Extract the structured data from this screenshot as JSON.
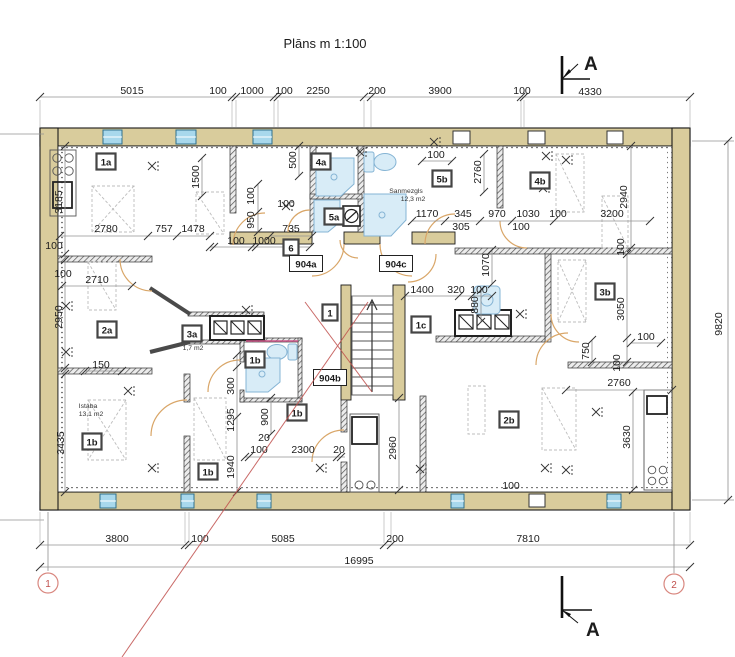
{
  "title": "Plāns  m  1:100",
  "scale_note": "1:100",
  "section_marker": "A",
  "grid_bubbles": [
    "1",
    "2"
  ],
  "colors": {
    "wall_tan": "#d9cc9c",
    "window_blue": "#a8d8ec",
    "markup_red": "#c0504d",
    "fixture_blue": "#d8ecf7",
    "door_arc": "#d9a668"
  },
  "annotations": [
    {
      "t": "Sanmezgls",
      "x": 406,
      "y": 193
    },
    {
      "t": "12,3 m2",
      "x": 413,
      "y": 201
    },
    {
      "t": "1,7 m2",
      "x": 193,
      "y": 350
    },
    {
      "t": "Istaba",
      "x": 88,
      "y": 408
    },
    {
      "t": "13,1 m2",
      "x": 91,
      "y": 416
    }
  ],
  "room_labels": [
    {
      "t": "1a",
      "x": 106,
      "y": 162
    },
    {
      "t": "4a",
      "x": 321,
      "y": 162
    },
    {
      "t": "5a",
      "x": 334,
      "y": 217
    },
    {
      "t": "5b",
      "x": 442,
      "y": 179
    },
    {
      "t": "4b",
      "x": 540,
      "y": 181
    },
    {
      "t": "6",
      "x": 291,
      "y": 248
    },
    {
      "t": "904a",
      "x": 306,
      "y": 264
    },
    {
      "t": "904c",
      "x": 396,
      "y": 264
    },
    {
      "t": "904b",
      "x": 330,
      "y": 378
    },
    {
      "t": "1",
      "x": 330,
      "y": 313
    },
    {
      "t": "1c",
      "x": 421,
      "y": 325
    },
    {
      "t": "3b",
      "x": 605,
      "y": 292
    },
    {
      "t": "2a",
      "x": 107,
      "y": 330
    },
    {
      "t": "3a",
      "x": 192,
      "y": 334
    },
    {
      "t": "1b",
      "x": 255,
      "y": 360
    },
    {
      "t": "1b",
      "x": 297,
      "y": 413
    },
    {
      "t": "1b",
      "x": 92,
      "y": 442
    },
    {
      "t": "1b",
      "x": 208,
      "y": 472
    },
    {
      "t": "2b",
      "x": 509,
      "y": 420
    }
  ],
  "dimension_labels": [
    {
      "t": "5015",
      "x": 132,
      "y": 94
    },
    {
      "t": "100",
      "x": 218,
      "y": 94
    },
    {
      "t": "1000",
      "x": 252,
      "y": 94
    },
    {
      "t": "100",
      "x": 284,
      "y": 94
    },
    {
      "t": "2250",
      "x": 318,
      "y": 94
    },
    {
      "t": "200",
      "x": 377,
      "y": 94
    },
    {
      "t": "3900",
      "x": 440,
      "y": 94
    },
    {
      "t": "100",
      "x": 522,
      "y": 94
    },
    {
      "t": "4330",
      "x": 590,
      "y": 95
    },
    {
      "t": "3800",
      "x": 117,
      "y": 542
    },
    {
      "t": "100",
      "x": 200,
      "y": 542
    },
    {
      "t": "5085",
      "x": 283,
      "y": 542
    },
    {
      "t": "200",
      "x": 395,
      "y": 542
    },
    {
      "t": "7810",
      "x": 528,
      "y": 542
    },
    {
      "t": "16995",
      "x": 359,
      "y": 564
    },
    {
      "t": "9820",
      "x": 722,
      "y": 324,
      "r": 1
    },
    {
      "t": "3185",
      "x": 62,
      "y": 202,
      "r": 1
    },
    {
      "t": "100",
      "x": 54,
      "y": 249
    },
    {
      "t": "100",
      "x": 63,
      "y": 277
    },
    {
      "t": "2950",
      "x": 62,
      "y": 317,
      "r": 1
    },
    {
      "t": "3435",
      "x": 64,
      "y": 443,
      "r": 1
    },
    {
      "t": "2780",
      "x": 106,
      "y": 232
    },
    {
      "t": "757",
      "x": 164,
      "y": 232
    },
    {
      "t": "1478",
      "x": 193,
      "y": 232
    },
    {
      "t": "1500",
      "x": 199,
      "y": 177,
      "r": 1
    },
    {
      "t": "500",
      "x": 296,
      "y": 160,
      "r": 1
    },
    {
      "t": "100",
      "x": 254,
      "y": 196,
      "r": 1
    },
    {
      "t": "950",
      "x": 254,
      "y": 220,
      "r": 1
    },
    {
      "t": "100",
      "x": 236,
      "y": 244
    },
    {
      "t": "1000",
      "x": 264,
      "y": 244
    },
    {
      "t": "735",
      "x": 291,
      "y": 232
    },
    {
      "t": "100",
      "x": 286,
      "y": 207
    },
    {
      "t": "100",
      "x": 436,
      "y": 158
    },
    {
      "t": "2760",
      "x": 481,
      "y": 172,
      "r": 1
    },
    {
      "t": "2940",
      "x": 627,
      "y": 197,
      "r": 1
    },
    {
      "t": "1170",
      "x": 427,
      "y": 217
    },
    {
      "t": "345",
      "x": 463,
      "y": 217
    },
    {
      "t": "970",
      "x": 497,
      "y": 217
    },
    {
      "t": "305",
      "x": 461,
      "y": 230
    },
    {
      "t": "1030",
      "x": 528,
      "y": 217
    },
    {
      "t": "100",
      "x": 558,
      "y": 217
    },
    {
      "t": "100",
      "x": 521,
      "y": 230
    },
    {
      "t": "3200",
      "x": 612,
      "y": 217
    },
    {
      "t": "100",
      "x": 624,
      "y": 247,
      "r": 1
    },
    {
      "t": "1400",
      "x": 422,
      "y": 293
    },
    {
      "t": "320",
      "x": 456,
      "y": 293
    },
    {
      "t": "100",
      "x": 479,
      "y": 293
    },
    {
      "t": "1070",
      "x": 489,
      "y": 265,
      "r": 1
    },
    {
      "t": "880",
      "x": 478,
      "y": 305,
      "r": 1
    },
    {
      "t": "3050",
      "x": 624,
      "y": 309,
      "r": 1
    },
    {
      "t": "100",
      "x": 646,
      "y": 340
    },
    {
      "t": "750",
      "x": 589,
      "y": 351,
      "r": 1
    },
    {
      "t": "100",
      "x": 620,
      "y": 363,
      "r": 1
    },
    {
      "t": "2760",
      "x": 619,
      "y": 386
    },
    {
      "t": "3630",
      "x": 630,
      "y": 437,
      "r": 1
    },
    {
      "t": "100",
      "x": 511,
      "y": 489
    },
    {
      "t": "2710",
      "x": 97,
      "y": 283
    },
    {
      "t": "150",
      "x": 101,
      "y": 368
    },
    {
      "t": "300",
      "x": 234,
      "y": 386,
      "r": 1
    },
    {
      "t": "1295",
      "x": 234,
      "y": 420,
      "r": 1
    },
    {
      "t": "1940",
      "x": 234,
      "y": 467,
      "r": 1
    },
    {
      "t": "900",
      "x": 268,
      "y": 417,
      "r": 1
    },
    {
      "t": "20",
      "x": 264,
      "y": 441
    },
    {
      "t": "100",
      "x": 259,
      "y": 453
    },
    {
      "t": "2300",
      "x": 303,
      "y": 453
    },
    {
      "t": "20",
      "x": 339,
      "y": 453
    },
    {
      "t": "2960",
      "x": 396,
      "y": 448,
      "r": 1
    }
  ]
}
